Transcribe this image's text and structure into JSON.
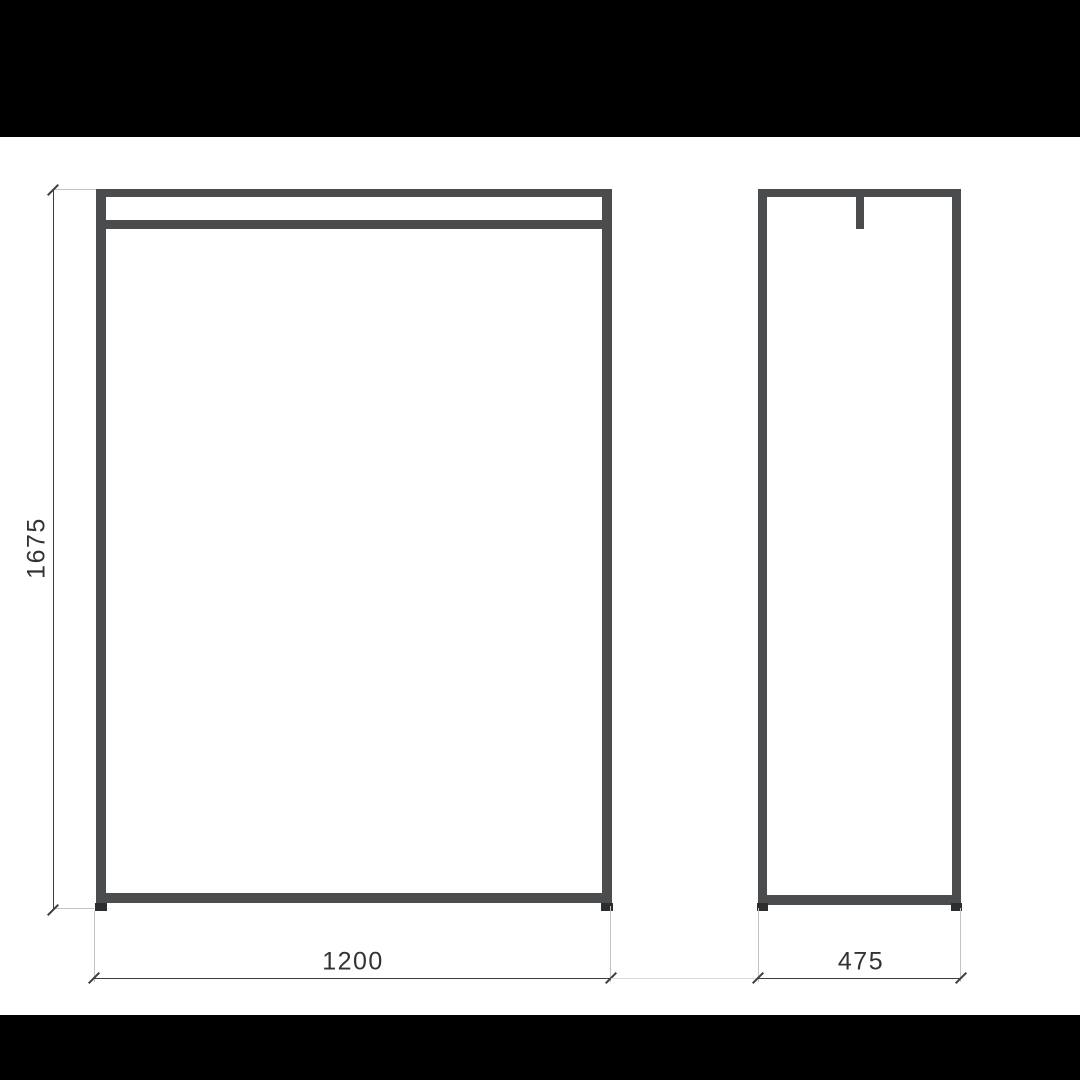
{
  "dimensions": {
    "height": "1675",
    "width": "1200",
    "depth": "475"
  },
  "colors": {
    "frame": "#4a4c4d",
    "foot": "#2b2d2e",
    "dim-line": "#3d3d3d",
    "ext-line": "#c4c4c4",
    "connector-line": "#dadada",
    "label-text": "#333333",
    "letterbox": "#000000",
    "paper": "#ffffff"
  }
}
